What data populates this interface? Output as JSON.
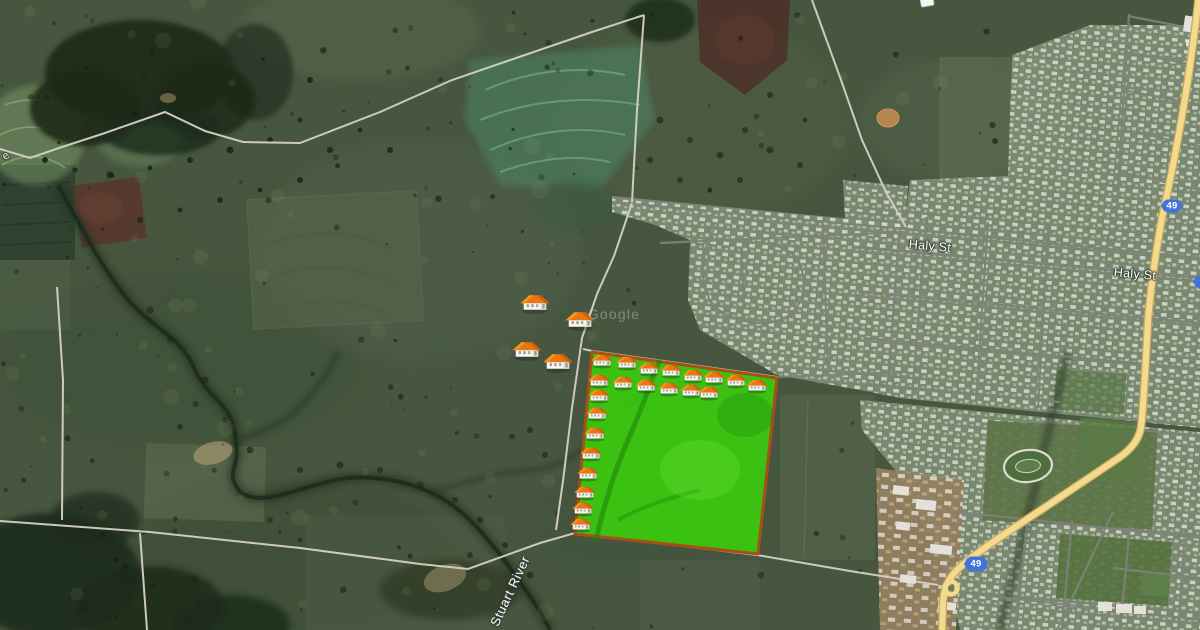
{
  "map": {
    "type": "satellite-aerial-view",
    "labels": {
      "street_1": {
        "text": "Haly St",
        "x": 930,
        "y": 246,
        "rotation": 5
      },
      "street_2": {
        "text": "Haly St",
        "x": 1135,
        "y": 274,
        "rotation": 5
      },
      "river": {
        "text": "Stuart River",
        "x": 510,
        "y": 591,
        "rotation": -65
      },
      "watermark": {
        "text": "Google",
        "x": 614,
        "y": 314,
        "rotation": 0
      },
      "edge_fragment": {
        "text": "e",
        "x": 6,
        "y": 156,
        "rotation": -35
      }
    },
    "route_shields": [
      {
        "label": "49",
        "x": 1172,
        "y": 206,
        "w": 22,
        "h": 13
      },
      {
        "label": "49",
        "x": 1206,
        "y": 282,
        "w": 26,
        "h": 14
      },
      {
        "label": "49",
        "x": 976,
        "y": 564,
        "w": 24,
        "h": 15
      }
    ],
    "highlight": {
      "corners": "592,352 777,378 758,554 575,534",
      "fill": "#38d908",
      "fill_opacity": "0.82",
      "border": "#a84f16",
      "border_width": "3"
    },
    "houses": {
      "outside": {
        "size": 30,
        "positions": [
          [
            535,
            305
          ],
          [
            580,
            322
          ],
          [
            527,
            352
          ],
          [
            558,
            364
          ]
        ]
      },
      "inside": {
        "size": 22,
        "positions": [
          [
            602,
            362
          ],
          [
            627,
            364
          ],
          [
            649,
            370
          ],
          [
            671,
            372
          ],
          [
            693,
            377
          ],
          [
            714,
            379
          ],
          [
            736,
            382
          ],
          [
            757,
            387
          ],
          [
            599,
            382
          ],
          [
            623,
            384
          ],
          [
            646,
            387
          ],
          [
            669,
            390
          ],
          [
            691,
            392
          ],
          [
            709,
            394
          ],
          [
            599,
            397
          ],
          [
            597,
            415
          ],
          [
            595,
            435
          ],
          [
            591,
            455
          ],
          [
            588,
            475
          ],
          [
            585,
            494
          ],
          [
            583,
            510
          ],
          [
            581,
            526
          ]
        ]
      }
    },
    "colors": {
      "highway_yellow": "#f3da8e",
      "shield_blue": "#4273d8",
      "town_street_gray": "#7d827b",
      "rural_road": "#d6d1c6",
      "highlight_green": "#38d908",
      "highlight_border": "#a84f16"
    }
  }
}
